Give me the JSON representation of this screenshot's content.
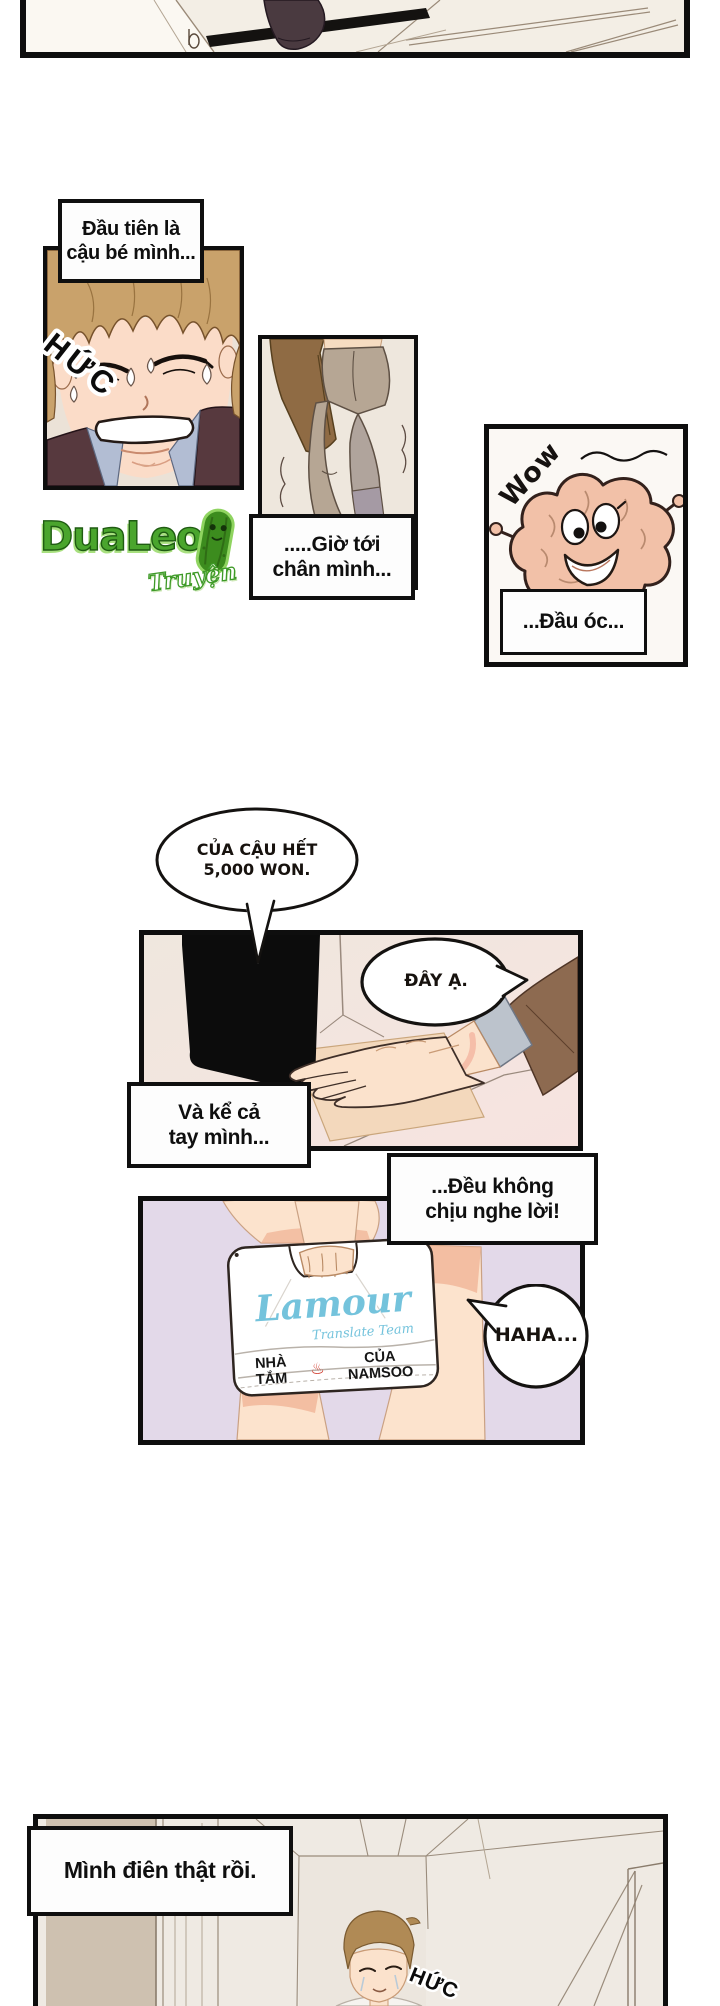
{
  "colors": {
    "panel_border": "#0e0e0e",
    "cream_panel_bg": "#f2ece3",
    "lavender_bg": "#e3d9e9",
    "logo_green": "#4aa52d",
    "lamour_blue": "#74c3dc",
    "steam_red": "#cf3527"
  },
  "captions": {
    "first": {
      "line1": "Đầu tiên là",
      "line2": "cậu bé mình..."
    },
    "legs": {
      "line1": ".....Giờ tới",
      "line2": "chân mình..."
    },
    "brain": {
      "text": "...Đầu óc..."
    },
    "hand": {
      "line1": "Và kể cả",
      "line2": "tay mình..."
    },
    "obey": {
      "line1": "...Đều không",
      "line2": "chịu nghe lời!"
    },
    "crazy": {
      "text": "Mình điên thật rồi."
    }
  },
  "bubbles": {
    "money": {
      "line1": "CỦA CẬU HẾT",
      "line2": "5,000 WON."
    },
    "reply": {
      "text": "ĐÂY Ạ."
    },
    "laugh": {
      "text": "HAHA..."
    }
  },
  "sfx": {
    "sob1": "HỨC",
    "wow": "Wow",
    "sob2": "HỨC"
  },
  "bag": {
    "brand": "Lamour",
    "brand_sub": "Translate Team",
    "label_left": "NHÀ TẮM",
    "steam_icon": "♨",
    "label_right": "CỦA NAMSOO"
  },
  "watermark": {
    "name": "DuaLeo",
    "sub": "Truyện"
  }
}
